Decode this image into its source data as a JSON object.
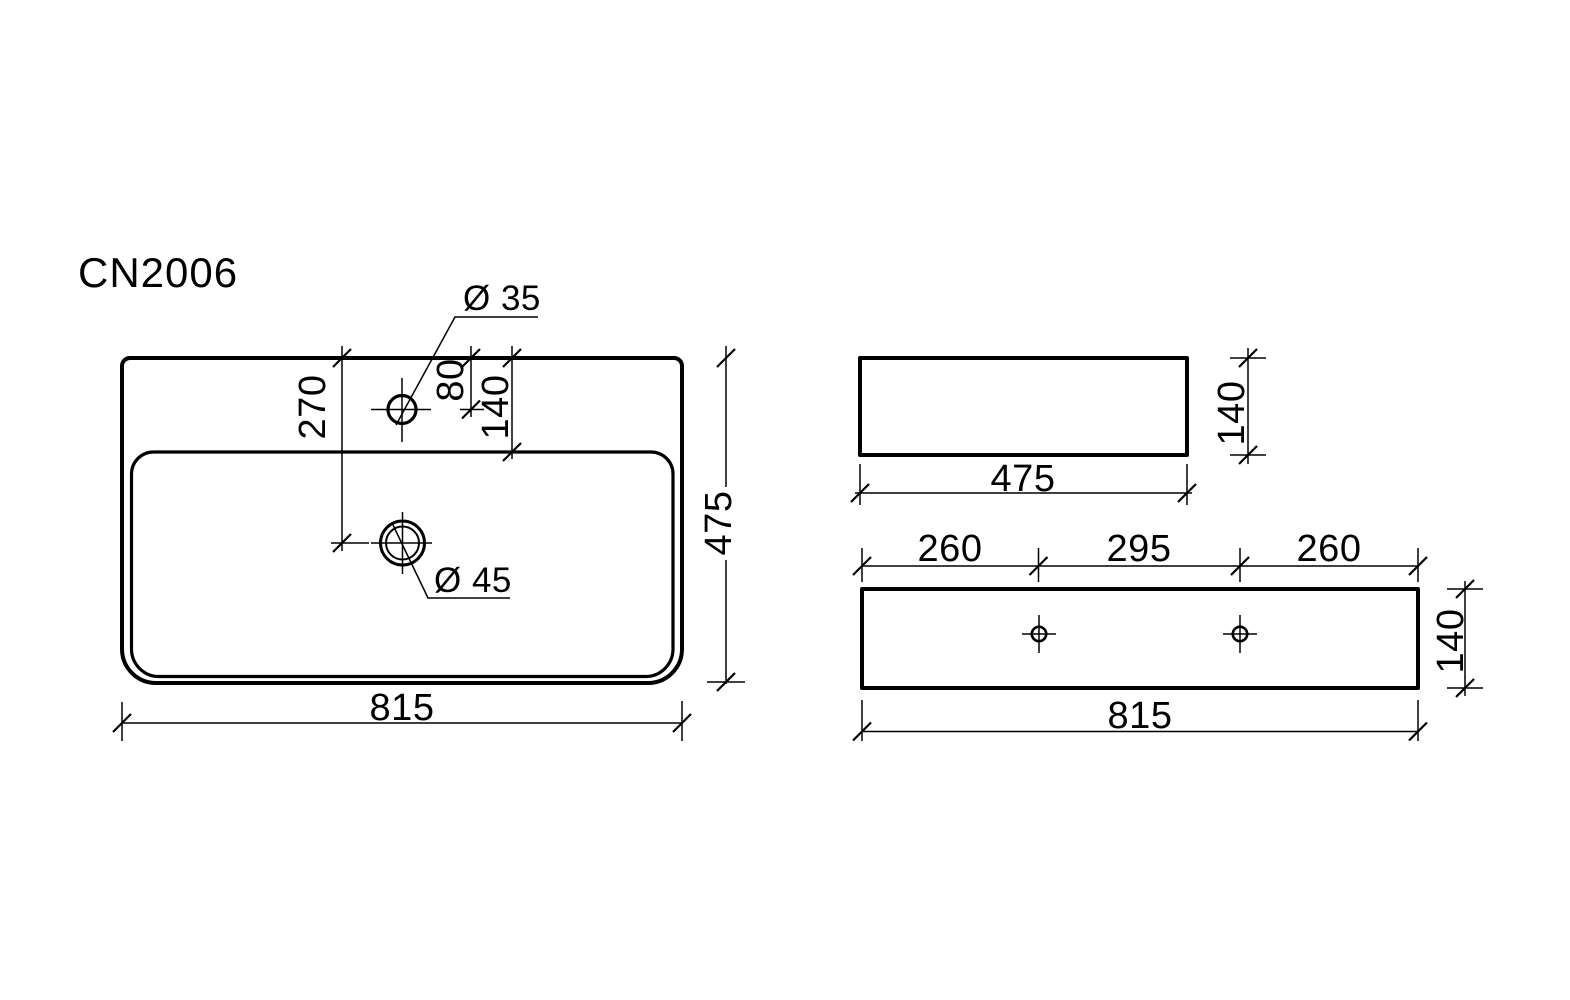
{
  "drawing": {
    "model": "CN2006",
    "colors": {
      "line": "#000000",
      "background": "#ffffff"
    },
    "top_view": {
      "overall_width": "815",
      "overall_depth": "475",
      "drain_offset_from_front": "270",
      "faucet_offset_from_front": "80",
      "basin_edge_offset": "140",
      "faucet_hole_diameter": "Ø 35",
      "drain_hole_diameter": "Ø 45"
    },
    "side_view": {
      "depth": "475",
      "height": "140"
    },
    "front_view": {
      "left_hole_span": "260",
      "center_hole_span": "295",
      "right_hole_span": "260",
      "overall_width": "815",
      "height": "140"
    }
  }
}
